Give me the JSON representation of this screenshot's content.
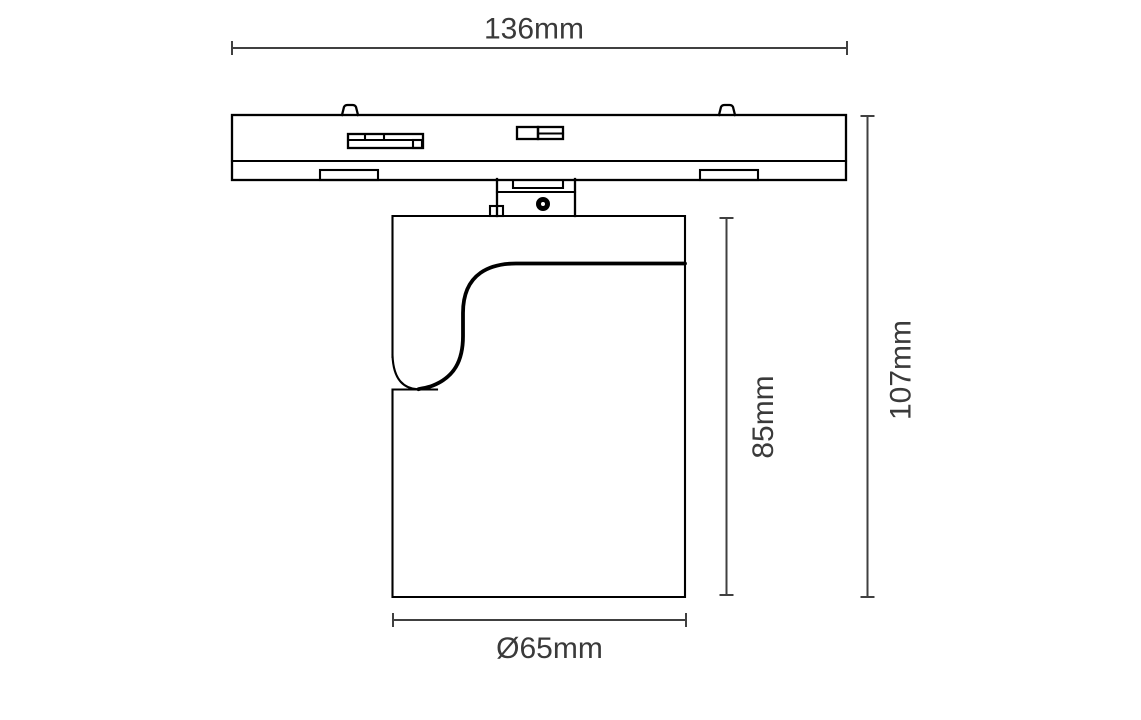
{
  "drawing": {
    "kind": "technical-dimension-drawing",
    "dimensions": {
      "track_width": {
        "label": "136mm"
      },
      "overall_height": {
        "label": "107mm"
      },
      "body_height": {
        "label": "85mm"
      },
      "body_diameter": {
        "label": "Ø65mm"
      }
    },
    "colors": {
      "line": "#000000",
      "dimension": "#404040",
      "text": "#3a3a3a",
      "background": "#ffffff"
    }
  }
}
